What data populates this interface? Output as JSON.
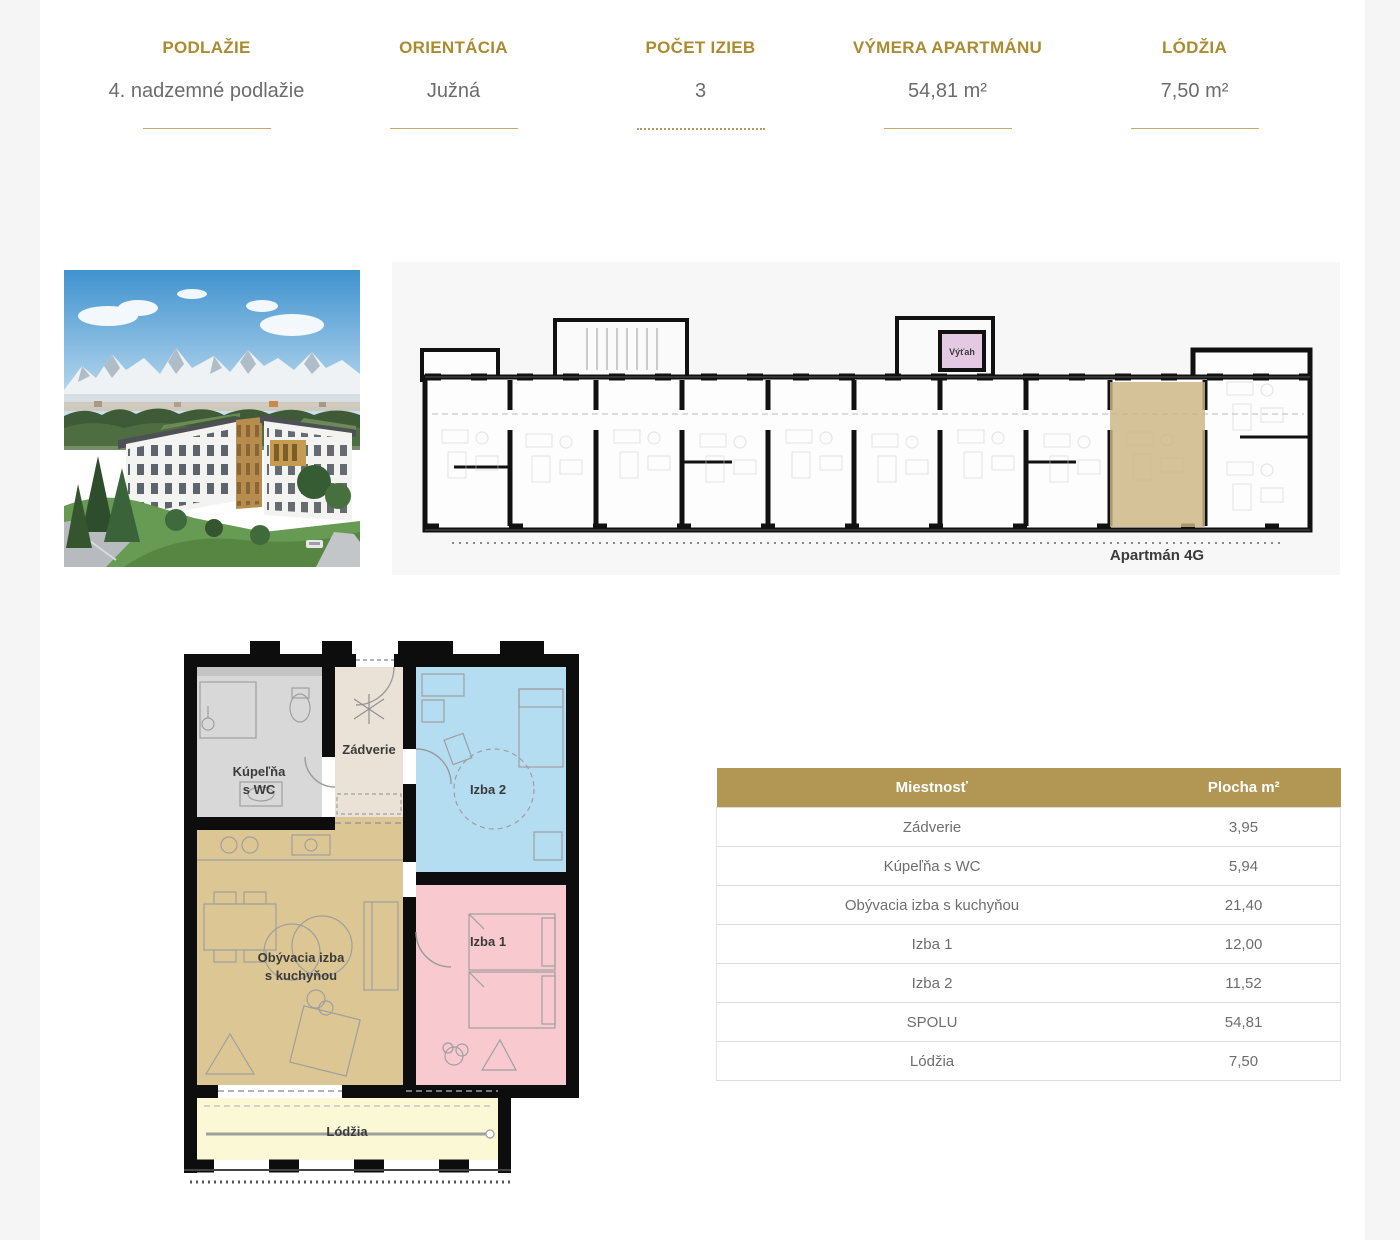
{
  "summary": {
    "items": [
      {
        "label": "PODLAŽIE",
        "value": "4. nadzemné podlažie"
      },
      {
        "label": "ORIENTÁCIA",
        "value": "Južná"
      },
      {
        "label": "POČET IZIEB",
        "value": "3"
      },
      {
        "label": "VÝMERA APARTMÁNU",
        "value": "54,81 m²"
      },
      {
        "label": "LÓDŽIA",
        "value": "7,50 m²"
      }
    ]
  },
  "overview_plan": {
    "apartment_label": "Apartmán 4G",
    "elevator_label": "Výťah"
  },
  "detail_plan": {
    "bathroom_line1": "Kúpeľňa",
    "bathroom_line2": "s WC",
    "hall": "Zádverie",
    "room2": "Izba 2",
    "living_line1": "Obývacia izba",
    "living_line2": "s kuchyňou",
    "room1": "Izba 1",
    "loggia": "Lódžia"
  },
  "area_table": {
    "header": {
      "room": "Miestnosť",
      "area": "Plocha m²"
    },
    "rows": [
      {
        "room": "Zádverie",
        "area": "3,95"
      },
      {
        "room": "Kúpeľňa s WC",
        "area": "5,94"
      },
      {
        "room": "Obývacia izba s kuchyňou",
        "area": "21,40"
      },
      {
        "room": "Izba 1",
        "area": "12,00"
      },
      {
        "room": "Izba 2",
        "area": "11,52"
      },
      {
        "room": "SPOLU",
        "area": "54,81"
      },
      {
        "room": "Lódžia",
        "area": "7,50"
      }
    ]
  },
  "colors": {
    "accent_gold": "#ab8b30",
    "rule_gold": "#c9a869",
    "table_header_bg": "#b29654",
    "value_text": "#6c6c6c",
    "highlight_tan": "#cdb583",
    "room_bath": "#d8d8d8",
    "room_hall": "#eae2d6",
    "room2_blue": "#b5ddf1",
    "room_living_tan": "#dcc794",
    "room1_pink": "#f8c9cf",
    "loggia_yellow": "#fbf8d6",
    "elevator_pink": "#e4c9e2"
  }
}
